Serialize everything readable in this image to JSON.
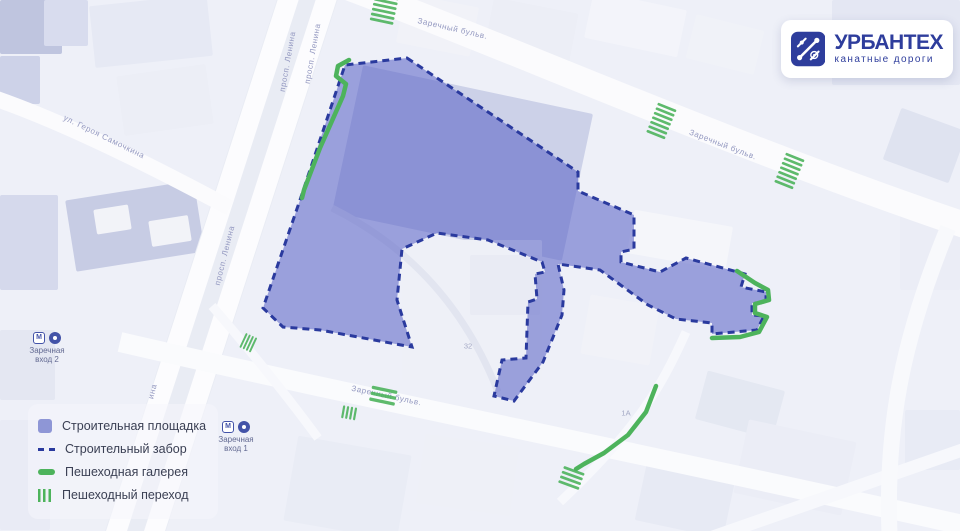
{
  "brand": {
    "name": "УРБАНТЕХ",
    "tagline": "канатные дороги"
  },
  "legend": {
    "items": [
      {
        "id": "site",
        "label": "Строительная площадка"
      },
      {
        "id": "fence",
        "label": "Строительный забор"
      },
      {
        "id": "gallery",
        "label": "Пешеходная галерея"
      },
      {
        "id": "crosswalk",
        "label": "Пешеходный переход"
      }
    ]
  },
  "colors": {
    "site_fill": "rgba(85,95,196,0.55)",
    "fence_stroke": "#2a3a9e",
    "green": "#4db35c",
    "road_label": "#9398c0",
    "brand_blue": "#2e3d9c"
  },
  "map": {
    "road_labels": [
      {
        "text": "Заречный бульв.",
        "x": 452,
        "y": 31,
        "rot": 13
      },
      {
        "text": "Заречный бульв.",
        "x": 722,
        "y": 147,
        "rot": 21
      },
      {
        "text": "просп. Ленина",
        "x": 290,
        "y": 62,
        "rot": -80
      },
      {
        "text": "просп. Ленина",
        "x": 315,
        "y": 54,
        "rot": -80
      },
      {
        "text": "просп. Ленина",
        "x": 227,
        "y": 256,
        "rot": -76
      },
      {
        "text": "ина",
        "x": 155,
        "y": 392,
        "rot": -76
      },
      {
        "text": "ул. Героя Самочкина",
        "x": 103,
        "y": 139,
        "rot": 26
      },
      {
        "text": "Заречный бульв.",
        "x": 386,
        "y": 398,
        "rot": 12
      }
    ],
    "building_labels": [
      {
        "text": "32",
        "x": 468,
        "y": 346
      },
      {
        "text": "1А",
        "x": 626,
        "y": 413
      }
    ],
    "metro_entrances": [
      {
        "name": "Заречная",
        "entrance": "вход 2",
        "x": 47,
        "y": 332
      },
      {
        "name": "Заречная",
        "entrance": "вход 1",
        "x": 236,
        "y": 421
      }
    ]
  },
  "overlay": {
    "site_polygon": [
      [
        407,
        58
      ],
      [
        578,
        172
      ],
      [
        578,
        191
      ],
      [
        634,
        215
      ],
      [
        634,
        249
      ],
      [
        621,
        252
      ],
      [
        621,
        262
      ],
      [
        660,
        272
      ],
      [
        686,
        258
      ],
      [
        745,
        274
      ],
      [
        741,
        287
      ],
      [
        766,
        292
      ],
      [
        766,
        303
      ],
      [
        752,
        303
      ],
      [
        752,
        315
      ],
      [
        764,
        316
      ],
      [
        757,
        330
      ],
      [
        712,
        334
      ],
      [
        712,
        323
      ],
      [
        676,
        319
      ],
      [
        648,
        305
      ],
      [
        600,
        270
      ],
      [
        558,
        264
      ],
      [
        564,
        290
      ],
      [
        562,
        315
      ],
      [
        543,
        362
      ],
      [
        514,
        401
      ],
      [
        494,
        396
      ],
      [
        502,
        360
      ],
      [
        526,
        358
      ],
      [
        528,
        302
      ],
      [
        537,
        299
      ],
      [
        535,
        274
      ],
      [
        545,
        272
      ],
      [
        542,
        262
      ],
      [
        488,
        240
      ],
      [
        437,
        233
      ],
      [
        402,
        249
      ],
      [
        397,
        300
      ],
      [
        412,
        347
      ],
      [
        320,
        330
      ],
      [
        283,
        327
      ],
      [
        263,
        308
      ],
      [
        300,
        200
      ],
      [
        345,
        65
      ]
    ],
    "galleries": [
      [
        [
          349,
          60
        ],
        [
          338,
          66
        ],
        [
          336,
          76
        ],
        [
          346,
          84
        ],
        [
          343,
          96
        ],
        [
          320,
          148
        ],
        [
          304,
          190
        ],
        [
          302,
          198
        ]
      ],
      [
        [
          737,
          271
        ],
        [
          755,
          283
        ],
        [
          768,
          290
        ],
        [
          769,
          300
        ],
        [
          755,
          304
        ],
        [
          755,
          313
        ],
        [
          767,
          317
        ],
        [
          759,
          332
        ],
        [
          740,
          337
        ],
        [
          712,
          338
        ]
      ],
      [
        [
          656,
          386
        ],
        [
          646,
          412
        ],
        [
          628,
          435
        ],
        [
          604,
          453
        ],
        [
          584,
          464
        ],
        [
          576,
          469
        ]
      ]
    ],
    "crossings": [
      {
        "x": 384,
        "y": 10,
        "w": 24,
        "h": 30,
        "rot": 12,
        "dir": "h"
      },
      {
        "x": 661,
        "y": 122,
        "w": 20,
        "h": 34,
        "rot": 22,
        "dir": "h"
      },
      {
        "x": 789,
        "y": 172,
        "w": 20,
        "h": 34,
        "rot": 22,
        "dir": "h"
      },
      {
        "x": 383,
        "y": 397,
        "w": 26,
        "h": 18,
        "rot": 12,
        "dir": "h"
      },
      {
        "x": 350,
        "y": 413,
        "w": 16,
        "h": 13,
        "rot": 10,
        "dir": "v"
      },
      {
        "x": 571,
        "y": 479,
        "w": 22,
        "h": 20,
        "rot": 20,
        "dir": "h"
      },
      {
        "x": 249,
        "y": 343,
        "w": 14,
        "h": 16,
        "rot": 25,
        "dir": "v"
      }
    ]
  }
}
